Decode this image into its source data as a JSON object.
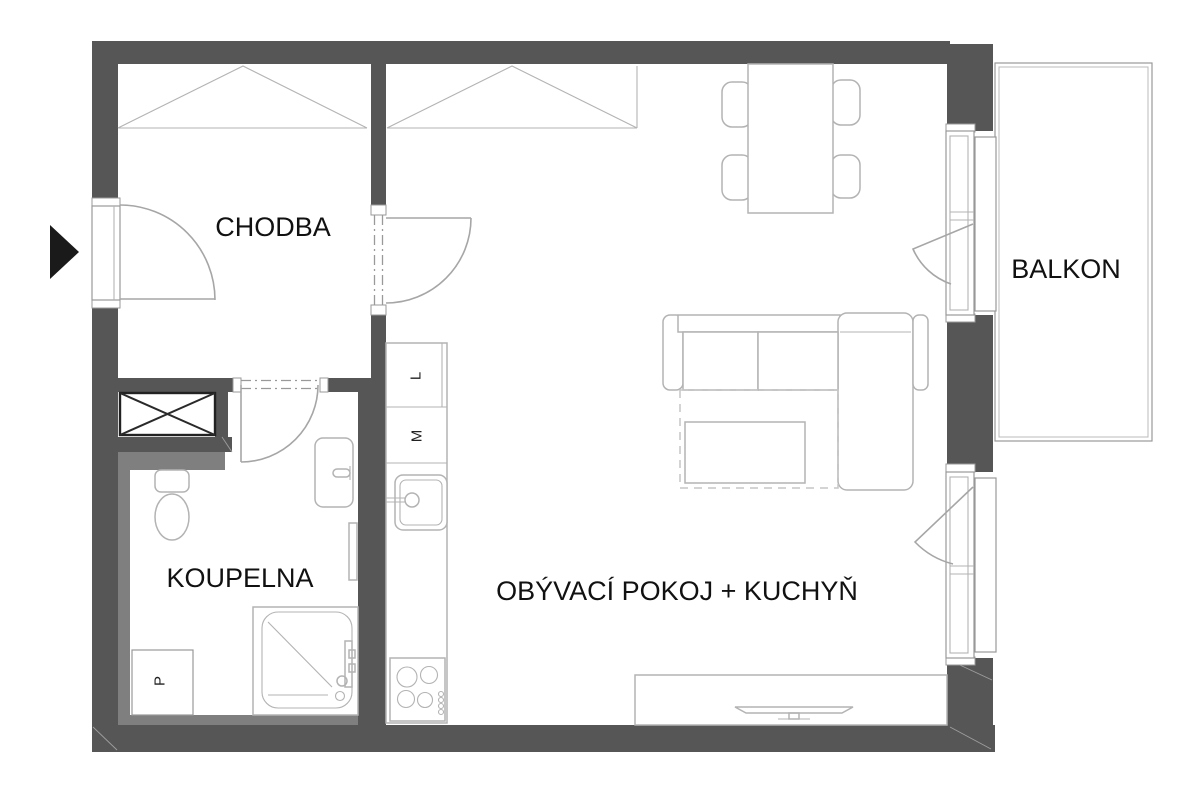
{
  "plan": {
    "title": "apartment floor plan",
    "rooms": [
      {
        "id": "chodba",
        "label": "CHODBA"
      },
      {
        "id": "koupelna",
        "label": "KOUPELNA"
      },
      {
        "id": "obyvaci-pokoj-kuchyn",
        "label": "OBÝVACÍ POKOJ + KUCHYŇ"
      },
      {
        "id": "balkon",
        "label": "BALKON"
      }
    ],
    "appliances": [
      {
        "id": "fridge",
        "label": "L"
      },
      {
        "id": "dishwasher",
        "label": "M"
      },
      {
        "id": "washer",
        "label": "P"
      }
    ],
    "colors": {
      "wall": "#565656",
      "furred": "#7f7f7f",
      "outline": "#b3b3b3",
      "door": "#a6a6a6",
      "jamb": "#999999",
      "text": "#111111",
      "arrow": "#1a1a1a",
      "background": "#ffffff"
    }
  }
}
